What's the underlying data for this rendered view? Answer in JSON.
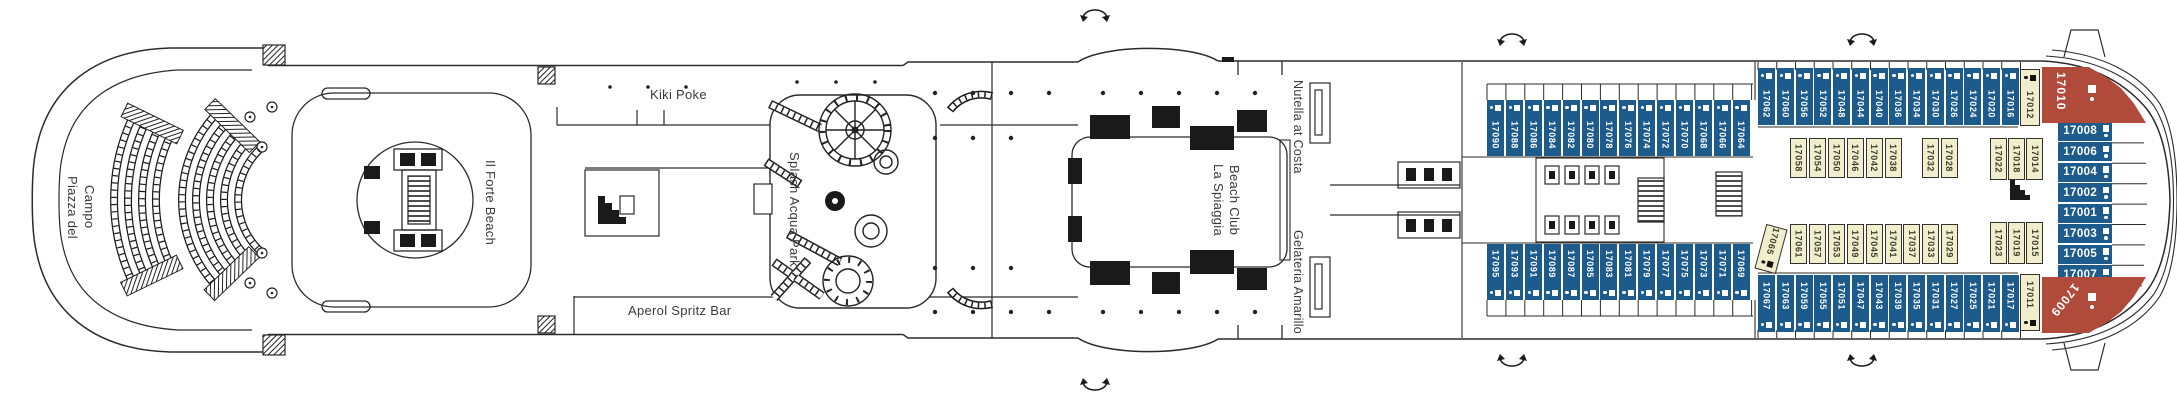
{
  "deck": {
    "type": "cruise-ship-deck-plan",
    "colors": {
      "balcony_blue": "#1e5b8d",
      "inside_yellow": "#f1eecd",
      "suite_red": "#b04b3b",
      "line_art": "#2b2b2b",
      "label_text": "#3a3a3a"
    }
  },
  "venues": {
    "piazza_del_campo_line1": "Piazza del",
    "piazza_del_campo_line2": "Campo",
    "il_forte_beach": "Il Forte Beach",
    "kiki_poke": "Kiki Poke",
    "aperol_spritz_bar": "Aperol Spritz Bar",
    "splash_acqua_park": "Splash Acqua Park",
    "la_spiaggia_line1": "La Spiaggia",
    "la_spiaggia_line2": "Beach Club",
    "nutella_at_costa": "Nutella at Costa",
    "gelateria_amarillo": "Gelateria Amarillo"
  },
  "icons": {
    "stairs": "stairs-icon",
    "elevator": "elevator-icon",
    "curved_arrow": "stairs-updown-arrow-icon",
    "sofa_square": "extra-berth-square-icon",
    "berth_dot": "upper-berth-dot-icon"
  },
  "cabin_rows": [
    {
      "id": "top-outer-fwd",
      "orient": "v",
      "color": "blue",
      "icons": "top",
      "x0": 1487,
      "pitch": 18.9,
      "y": 100,
      "w": 17,
      "h": 56,
      "numbers": [
        "17090",
        "17088",
        "17086",
        "17084",
        "17082",
        "17080",
        "17078",
        "17076",
        "17074",
        "17072",
        "17070",
        "17068",
        "17066",
        "17064"
      ]
    },
    {
      "id": "top-outer-aft",
      "orient": "v",
      "color": "blue",
      "icons": "top",
      "x0": 1758,
      "pitch": 18.75,
      "y": 68,
      "w": 17,
      "h": 57,
      "numbers": [
        "17062",
        "17060",
        "17056",
        "17052",
        "17048",
        "17044",
        "17040",
        "17036",
        "17034",
        "17030",
        "17026",
        "17024",
        "17020",
        "17016"
      ]
    },
    {
      "id": "top-inner-fwd",
      "orient": "v",
      "color": "yellow",
      "icons": "none",
      "x0": 1790,
      "pitch": 18.9,
      "y": 138,
      "w": 17,
      "h": 40,
      "numbers": [
        "17058",
        "17054",
        "17050",
        "17046",
        "17042",
        "17038"
      ]
    },
    {
      "id": "top-inner-mid",
      "orient": "v",
      "color": "yellow",
      "icons": "none",
      "x0": 1922,
      "pitch": 18.5,
      "y": 138,
      "w": 17,
      "h": 40,
      "numbers": [
        "17032",
        "17028"
      ]
    },
    {
      "id": "top-inner-aft",
      "orient": "v",
      "color": "yellow",
      "icons": "none",
      "x0": 1990,
      "pitch": 18.2,
      "y": 138,
      "w": 17,
      "h": 42,
      "numbers": [
        "17022",
        "17018",
        "17014"
      ]
    },
    {
      "id": "bottom-inner-fwd",
      "orient": "v",
      "color": "yellow",
      "icons": "none",
      "x0": 1790,
      "pitch": 18.9,
      "y": 224,
      "w": 17,
      "h": 40,
      "numbers": [
        "17061",
        "17057",
        "17053",
        "17049",
        "17045",
        "17041",
        "17037",
        "17033",
        "17029"
      ]
    },
    {
      "id": "bottom-inner-aft",
      "orient": "v",
      "color": "yellow",
      "icons": "none",
      "x0": 1990,
      "pitch": 18.2,
      "y": 222,
      "w": 17,
      "h": 42,
      "numbers": [
        "17023",
        "17019",
        "17015"
      ]
    },
    {
      "id": "bottom-outer-fwd",
      "orient": "v",
      "color": "blue",
      "icons": "bottom",
      "x0": 1487,
      "pitch": 18.9,
      "y": 244,
      "w": 17,
      "h": 56,
      "numbers": [
        "17095",
        "17093",
        "17091",
        "17089",
        "17087",
        "17085",
        "17083",
        "17081",
        "17079",
        "17077",
        "17075",
        "17073",
        "17071",
        "17069"
      ]
    },
    {
      "id": "bottom-outer-aft",
      "orient": "v",
      "color": "blue",
      "icons": "bottom",
      "x0": 1758,
      "pitch": 18.75,
      "y": 275,
      "w": 17,
      "h": 57,
      "numbers": [
        "17067",
        "17063",
        "17059",
        "17055",
        "17051",
        "17047",
        "17043",
        "17039",
        "17035",
        "17031",
        "17027",
        "17025",
        "17021",
        "17017"
      ]
    },
    {
      "id": "stern-facing",
      "orient": "h",
      "color": "blue",
      "icons": "right",
      "x": 2058,
      "y0": 121.5,
      "pitch": 20.5,
      "w": 54,
      "h": 19,
      "numbers": [
        "17008",
        "17006",
        "17004",
        "17002",
        "17001",
        "17003",
        "17005",
        "17007"
      ]
    }
  ],
  "special_cabins": [
    {
      "number": "17012",
      "kind": "inside-top",
      "x": 2020,
      "y": 69,
      "w": 20,
      "h": 57
    },
    {
      "number": "17011",
      "kind": "inside-bottom",
      "x": 2020,
      "y": 274,
      "w": 20,
      "h": 57
    },
    {
      "number": "17065",
      "kind": "inside-tilt",
      "x": 1760,
      "y": 226,
      "w": 22,
      "h": 46,
      "rotate": 15
    },
    {
      "number": "17010",
      "kind": "suite-top",
      "x": 2042,
      "y": 67,
      "w": 104,
      "h": 56
    },
    {
      "number": "17009",
      "kind": "suite-bottom",
      "x": 2042,
      "y": 277,
      "w": 104,
      "h": 56
    }
  ]
}
